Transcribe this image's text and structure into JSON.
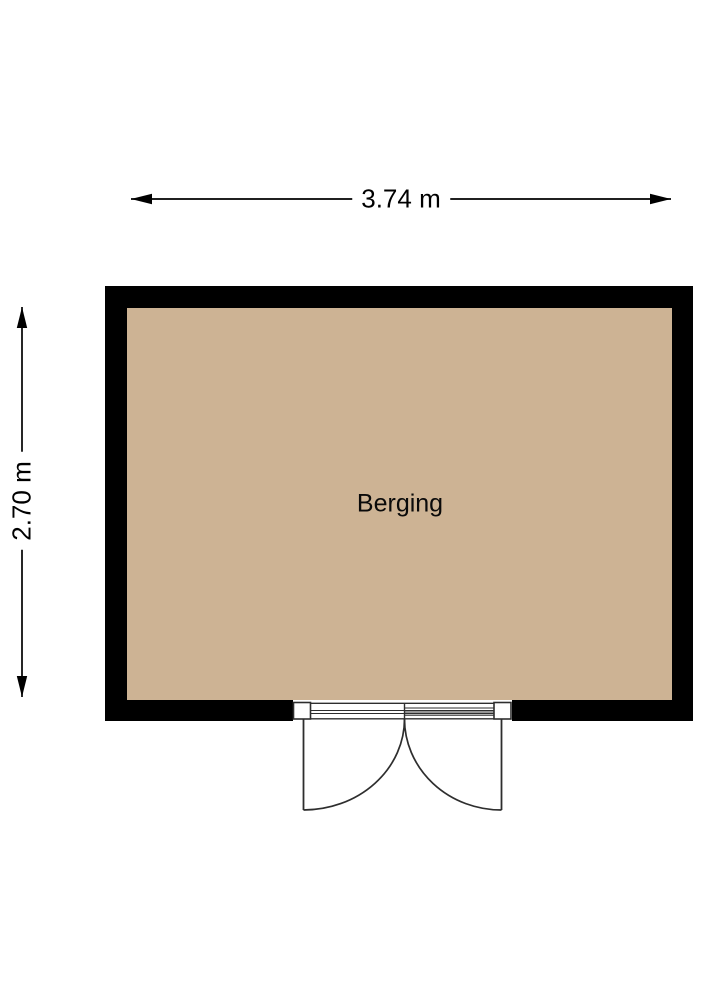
{
  "figure": {
    "type": "floor-plan",
    "room": {
      "name": "Berging"
    },
    "dimensions": {
      "width_label": "3.74 m",
      "height_label": "2.70 m"
    },
    "door": {
      "type": "double-door",
      "wall": "bottom",
      "swing": "outward"
    },
    "colors": {
      "background": "#FFFFFF",
      "floor": "#CDB394",
      "wall": "#000000",
      "door_line": "#2E2E2E",
      "text": "#000000"
    }
  }
}
